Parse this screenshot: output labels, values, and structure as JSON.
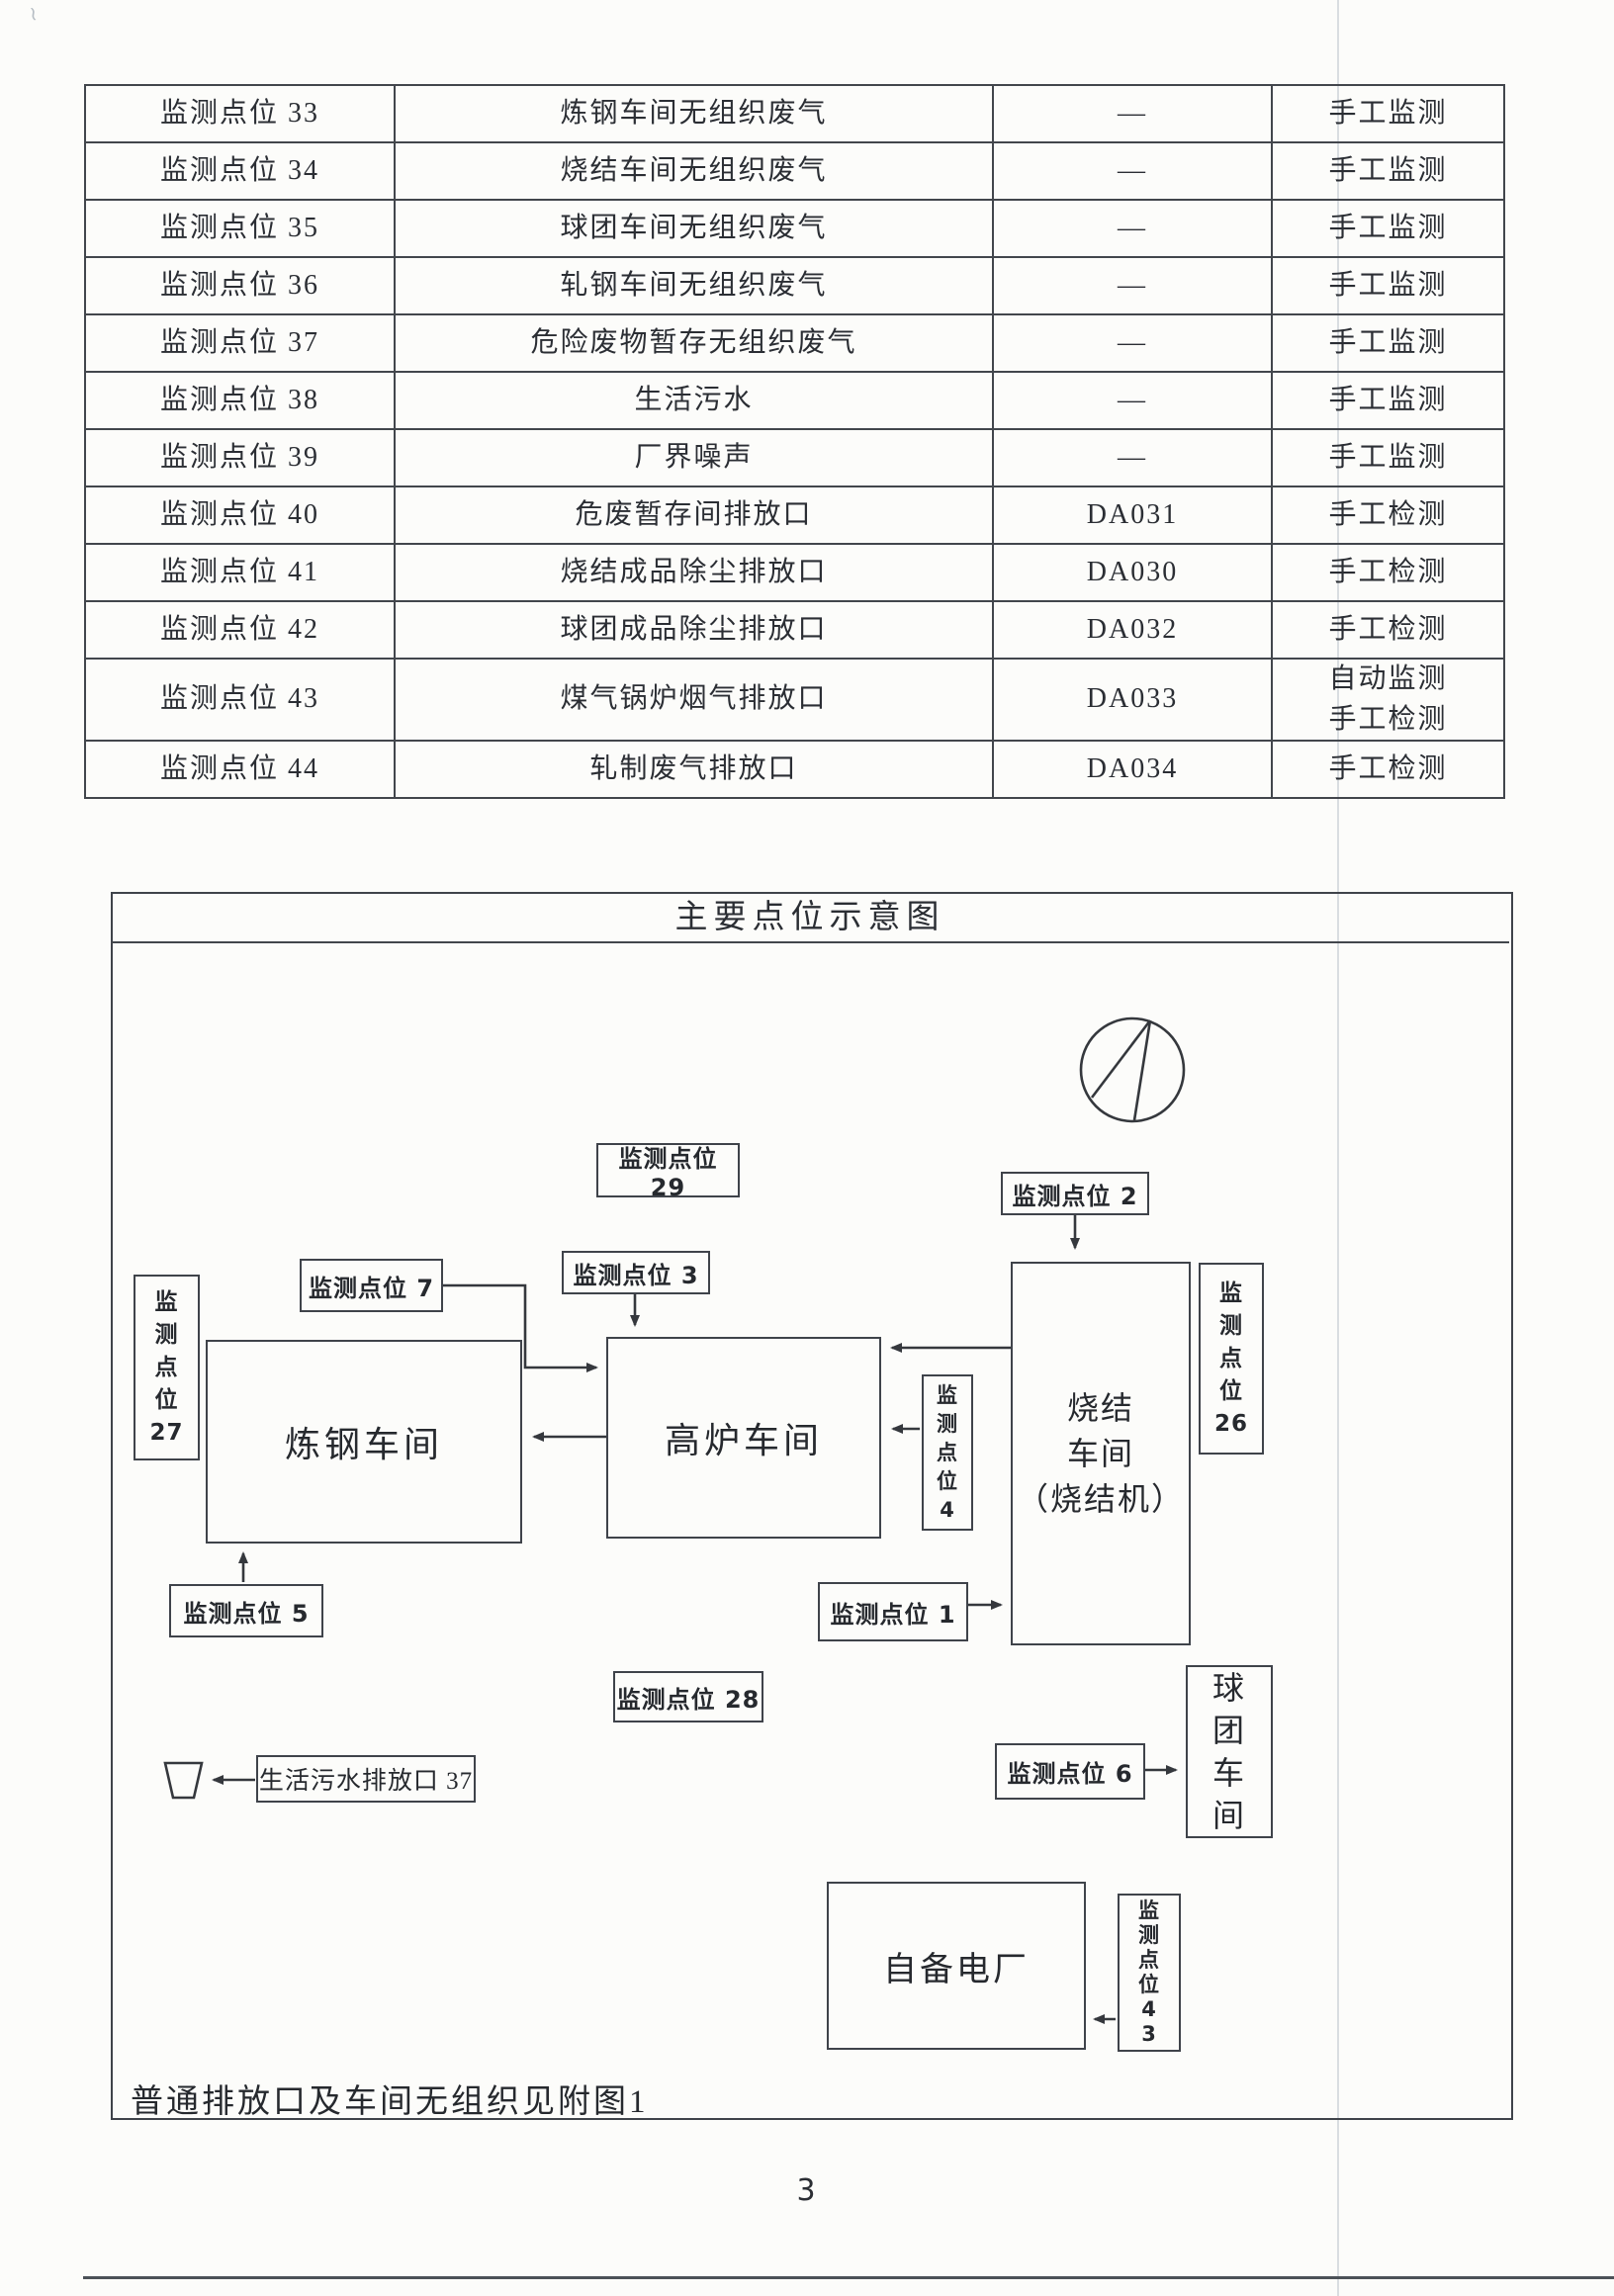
{
  "page": {
    "number": "3",
    "footnote": "普通排放口及车间无组织见附图1"
  },
  "table": {
    "rows": [
      {
        "point": "监测点位 33",
        "desc": "炼钢车间无组织废气",
        "code": "—",
        "method": "手工监测"
      },
      {
        "point": "监测点位 34",
        "desc": "烧结车间无组织废气",
        "code": "—",
        "method": "手工监测"
      },
      {
        "point": "监测点位 35",
        "desc": "球团车间无组织废气",
        "code": "—",
        "method": "手工监测"
      },
      {
        "point": "监测点位 36",
        "desc": "轧钢车间无组织废气",
        "code": "—",
        "method": "手工监测"
      },
      {
        "point": "监测点位 37",
        "desc": "危险废物暂存无组织废气",
        "code": "—",
        "method": "手工监测"
      },
      {
        "point": "监测点位 38",
        "desc": "生活污水",
        "code": "—",
        "method": "手工监测"
      },
      {
        "point": "监测点位 39",
        "desc": "厂界噪声",
        "code": "—",
        "method": "手工监测"
      },
      {
        "point": "监测点位 40",
        "desc": "危废暂存间排放口",
        "code": "DA031",
        "method": "手工检测"
      },
      {
        "point": "监测点位 41",
        "desc": "烧结成品除尘排放口",
        "code": "DA030",
        "method": "手工检测"
      },
      {
        "point": "监测点位 42",
        "desc": "球团成品除尘排放口",
        "code": "DA032",
        "method": "手工检测"
      },
      {
        "point": "监测点位 43",
        "desc": "煤气锅炉烟气排放口",
        "code": "DA033",
        "method": "自动监测\n手工检测"
      },
      {
        "point": "监测点位 44",
        "desc": "轧制废气排放口",
        "code": "DA034",
        "method": "手工检测"
      }
    ]
  },
  "diagram": {
    "title": "主要点位示意图",
    "icons": {
      "north_arrow": "north-arrow-compass",
      "sewage_outlet": "sewage-outlet-trapezoid"
    },
    "workshops": {
      "steel": "炼钢车间",
      "furnace": "高炉车间",
      "sinter": "烧结\n车间\n（烧结机）",
      "pellet": "球\n团\n车\n间",
      "power": "自备电厂"
    },
    "points": {
      "p29": "监测点位 29",
      "p2": "监测点位 2",
      "p7": "监测点位 7",
      "p3": "监测点位 3",
      "p27": "监\n测\n点\n位\n27",
      "p26": "监\n测\n点\n位\n26",
      "p4": "监\n测\n点\n位\n4",
      "p5": "监测点位 5",
      "p1": "监测点位 1",
      "p28": "监测点位 28",
      "p6": "监测点位 6",
      "p37": "生活污水排放口 37",
      "p43": "监\n测\n点\n位\n4\n3"
    }
  }
}
